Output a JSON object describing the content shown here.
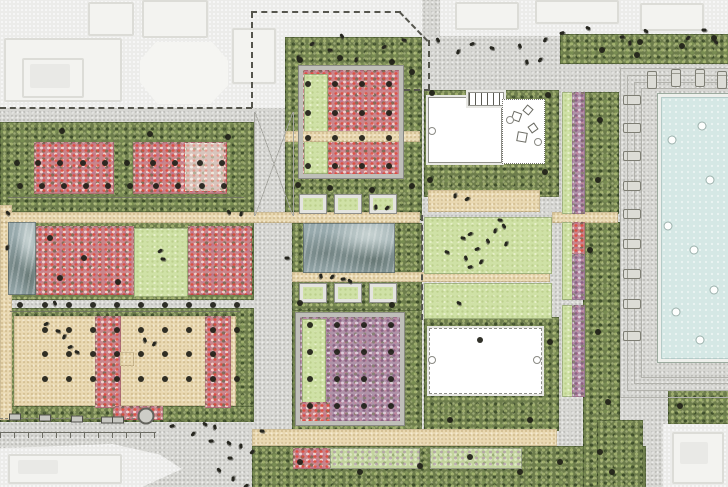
{
  "meta": {
    "type": "landscape-architecture-site-plan",
    "description": "Top-down rendered master plan: flower gardens with tree bosques, lawns, reflecting pool, pavilions, planters and a swimming pool with sun loungers; faded existing buildings outside dashed project boundary"
  },
  "palette": {
    "plaza_gray": "#d6d6d2",
    "path_beige": "#e9d8b1",
    "meadow_green": "#6d7d4c",
    "lawn_green": "#cfe1a6",
    "flowers_red": "#c9868b",
    "flowers_purple": "#ae92a8",
    "water_gray": "#97a9ac",
    "pool_blue": "#d5e8e5",
    "building_white": "#ffffff",
    "context_faded": "#ececea",
    "tree_black": "#1f1f18",
    "boundary_dash": "#55554d"
  },
  "plan": {
    "tree_rows": [
      {
        "y": 163,
        "x": [
          17,
          38,
          60,
          83,
          105,
          127,
          153,
          175,
          200,
          222
        ]
      },
      {
        "y": 186,
        "x": [
          20,
          42,
          64,
          86,
          108,
          130,
          156,
          178,
          202,
          224
        ]
      },
      {
        "y": 305,
        "x": [
          20,
          45,
          69,
          93,
          117,
          141,
          165,
          189,
          213,
          237
        ]
      },
      {
        "y": 330,
        "x": [
          45,
          69,
          93,
          117,
          141,
          165,
          189,
          213,
          237
        ]
      },
      {
        "y": 354,
        "x": [
          45,
          69,
          93,
          117,
          141,
          165,
          189,
          213
        ]
      },
      {
        "y": 379,
        "x": [
          45,
          69,
          93,
          117,
          141,
          165,
          189,
          213,
          237
        ]
      },
      {
        "y": 84,
        "x": [
          308,
          335,
          362,
          389
        ]
      },
      {
        "y": 113,
        "x": [
          308,
          335,
          362,
          389
        ]
      },
      {
        "y": 138,
        "x": [
          308,
          335,
          362,
          389
        ]
      },
      {
        "y": 166,
        "x": [
          308,
          335,
          362,
          389
        ]
      },
      {
        "y": 325,
        "x": [
          310,
          337,
          364,
          391
        ]
      },
      {
        "y": 352,
        "x": [
          310,
          337,
          364,
          391
        ]
      },
      {
        "y": 379,
        "x": [
          310,
          337,
          364,
          391
        ]
      },
      {
        "y": 406,
        "x": [
          310,
          337,
          364,
          391
        ]
      }
    ],
    "trees": [
      [
        62,
        131
      ],
      [
        150,
        134
      ],
      [
        228,
        137
      ],
      [
        50,
        238
      ],
      [
        84,
        258
      ],
      [
        118,
        282
      ],
      [
        60,
        278
      ],
      [
        300,
        60
      ],
      [
        340,
        58
      ],
      [
        392,
        62
      ],
      [
        412,
        72
      ],
      [
        298,
        185
      ],
      [
        330,
        188
      ],
      [
        372,
        190
      ],
      [
        412,
        186
      ],
      [
        300,
        303
      ],
      [
        392,
        305
      ],
      [
        432,
        93
      ],
      [
        548,
        95
      ],
      [
        430,
        180
      ],
      [
        545,
        172
      ],
      [
        602,
        50
      ],
      [
        637,
        55
      ],
      [
        640,
        42
      ],
      [
        682,
        46
      ],
      [
        714,
        38
      ],
      [
        600,
        120
      ],
      [
        598,
        180
      ],
      [
        590,
        250
      ],
      [
        598,
        332
      ],
      [
        608,
        402
      ],
      [
        600,
        452
      ],
      [
        300,
        462
      ],
      [
        360,
        472
      ],
      [
        420,
        466
      ],
      [
        470,
        457
      ],
      [
        520,
        472
      ],
      [
        560,
        462
      ],
      [
        612,
        472
      ],
      [
        680,
        406
      ],
      [
        450,
        420
      ],
      [
        530,
        420
      ],
      [
        480,
        340
      ],
      [
        550,
        342
      ]
    ],
    "people": [
      [
        298,
        58
      ],
      [
        312,
        44
      ],
      [
        330,
        50
      ],
      [
        342,
        36
      ],
      [
        356,
        60
      ],
      [
        384,
        47
      ],
      [
        404,
        40
      ],
      [
        438,
        40
      ],
      [
        458,
        52
      ],
      [
        472,
        44
      ],
      [
        492,
        48
      ],
      [
        520,
        46
      ],
      [
        545,
        40
      ],
      [
        562,
        33
      ],
      [
        588,
        28
      ],
      [
        527,
        62
      ],
      [
        540,
        60
      ],
      [
        622,
        37
      ],
      [
        646,
        31
      ],
      [
        630,
        43
      ],
      [
        688,
        38
      ],
      [
        704,
        30
      ],
      [
        716,
        42
      ],
      [
        455,
        196
      ],
      [
        467,
        199
      ],
      [
        500,
        220
      ],
      [
        504,
        226
      ],
      [
        495,
        231
      ],
      [
        470,
        234
      ],
      [
        463,
        238
      ],
      [
        488,
        241
      ],
      [
        506,
        244
      ],
      [
        477,
        249
      ],
      [
        447,
        252
      ],
      [
        466,
        258
      ],
      [
        481,
        262
      ],
      [
        470,
        267
      ],
      [
        459,
        303
      ],
      [
        321,
        276
      ],
      [
        332,
        277
      ],
      [
        343,
        279
      ],
      [
        350,
        281
      ],
      [
        376,
        207
      ],
      [
        387,
        208
      ],
      [
        287,
        258
      ],
      [
        8,
        213
      ],
      [
        7,
        248
      ],
      [
        160,
        251
      ],
      [
        163,
        259
      ],
      [
        229,
        212
      ],
      [
        241,
        214
      ],
      [
        46,
        324
      ],
      [
        58,
        331
      ],
      [
        55,
        303
      ],
      [
        64,
        337
      ],
      [
        70,
        347
      ],
      [
        77,
        352
      ],
      [
        145,
        340
      ],
      [
        154,
        344
      ],
      [
        172,
        426
      ],
      [
        205,
        424
      ],
      [
        215,
        427
      ],
      [
        193,
        434
      ],
      [
        211,
        441
      ],
      [
        229,
        443
      ],
      [
        241,
        446
      ],
      [
        252,
        452
      ],
      [
        230,
        458
      ],
      [
        219,
        470
      ],
      [
        233,
        479
      ],
      [
        246,
        486
      ],
      [
        262,
        431
      ]
    ],
    "benches": [
      [
        15,
        417
      ],
      [
        45,
        418
      ],
      [
        77,
        419
      ],
      [
        107,
        420
      ],
      [
        118,
        420
      ]
    ],
    "rings": [
      [
        146,
        416
      ]
    ],
    "loungers_h": [
      [
        632,
        100
      ],
      [
        632,
        128
      ],
      [
        632,
        156
      ],
      [
        632,
        186
      ],
      [
        632,
        214
      ],
      [
        632,
        244
      ],
      [
        632,
        274
      ],
      [
        632,
        304
      ],
      [
        632,
        336
      ]
    ],
    "loungers_v": [
      [
        652,
        80
      ],
      [
        676,
        78
      ],
      [
        700,
        78
      ],
      [
        722,
        80
      ]
    ],
    "pool_floats": [
      [
        672,
        140
      ],
      [
        702,
        126
      ],
      [
        710,
        180
      ],
      [
        668,
        226
      ],
      [
        694,
        250
      ],
      [
        714,
        290
      ],
      [
        676,
        312
      ],
      [
        700,
        340
      ]
    ]
  }
}
